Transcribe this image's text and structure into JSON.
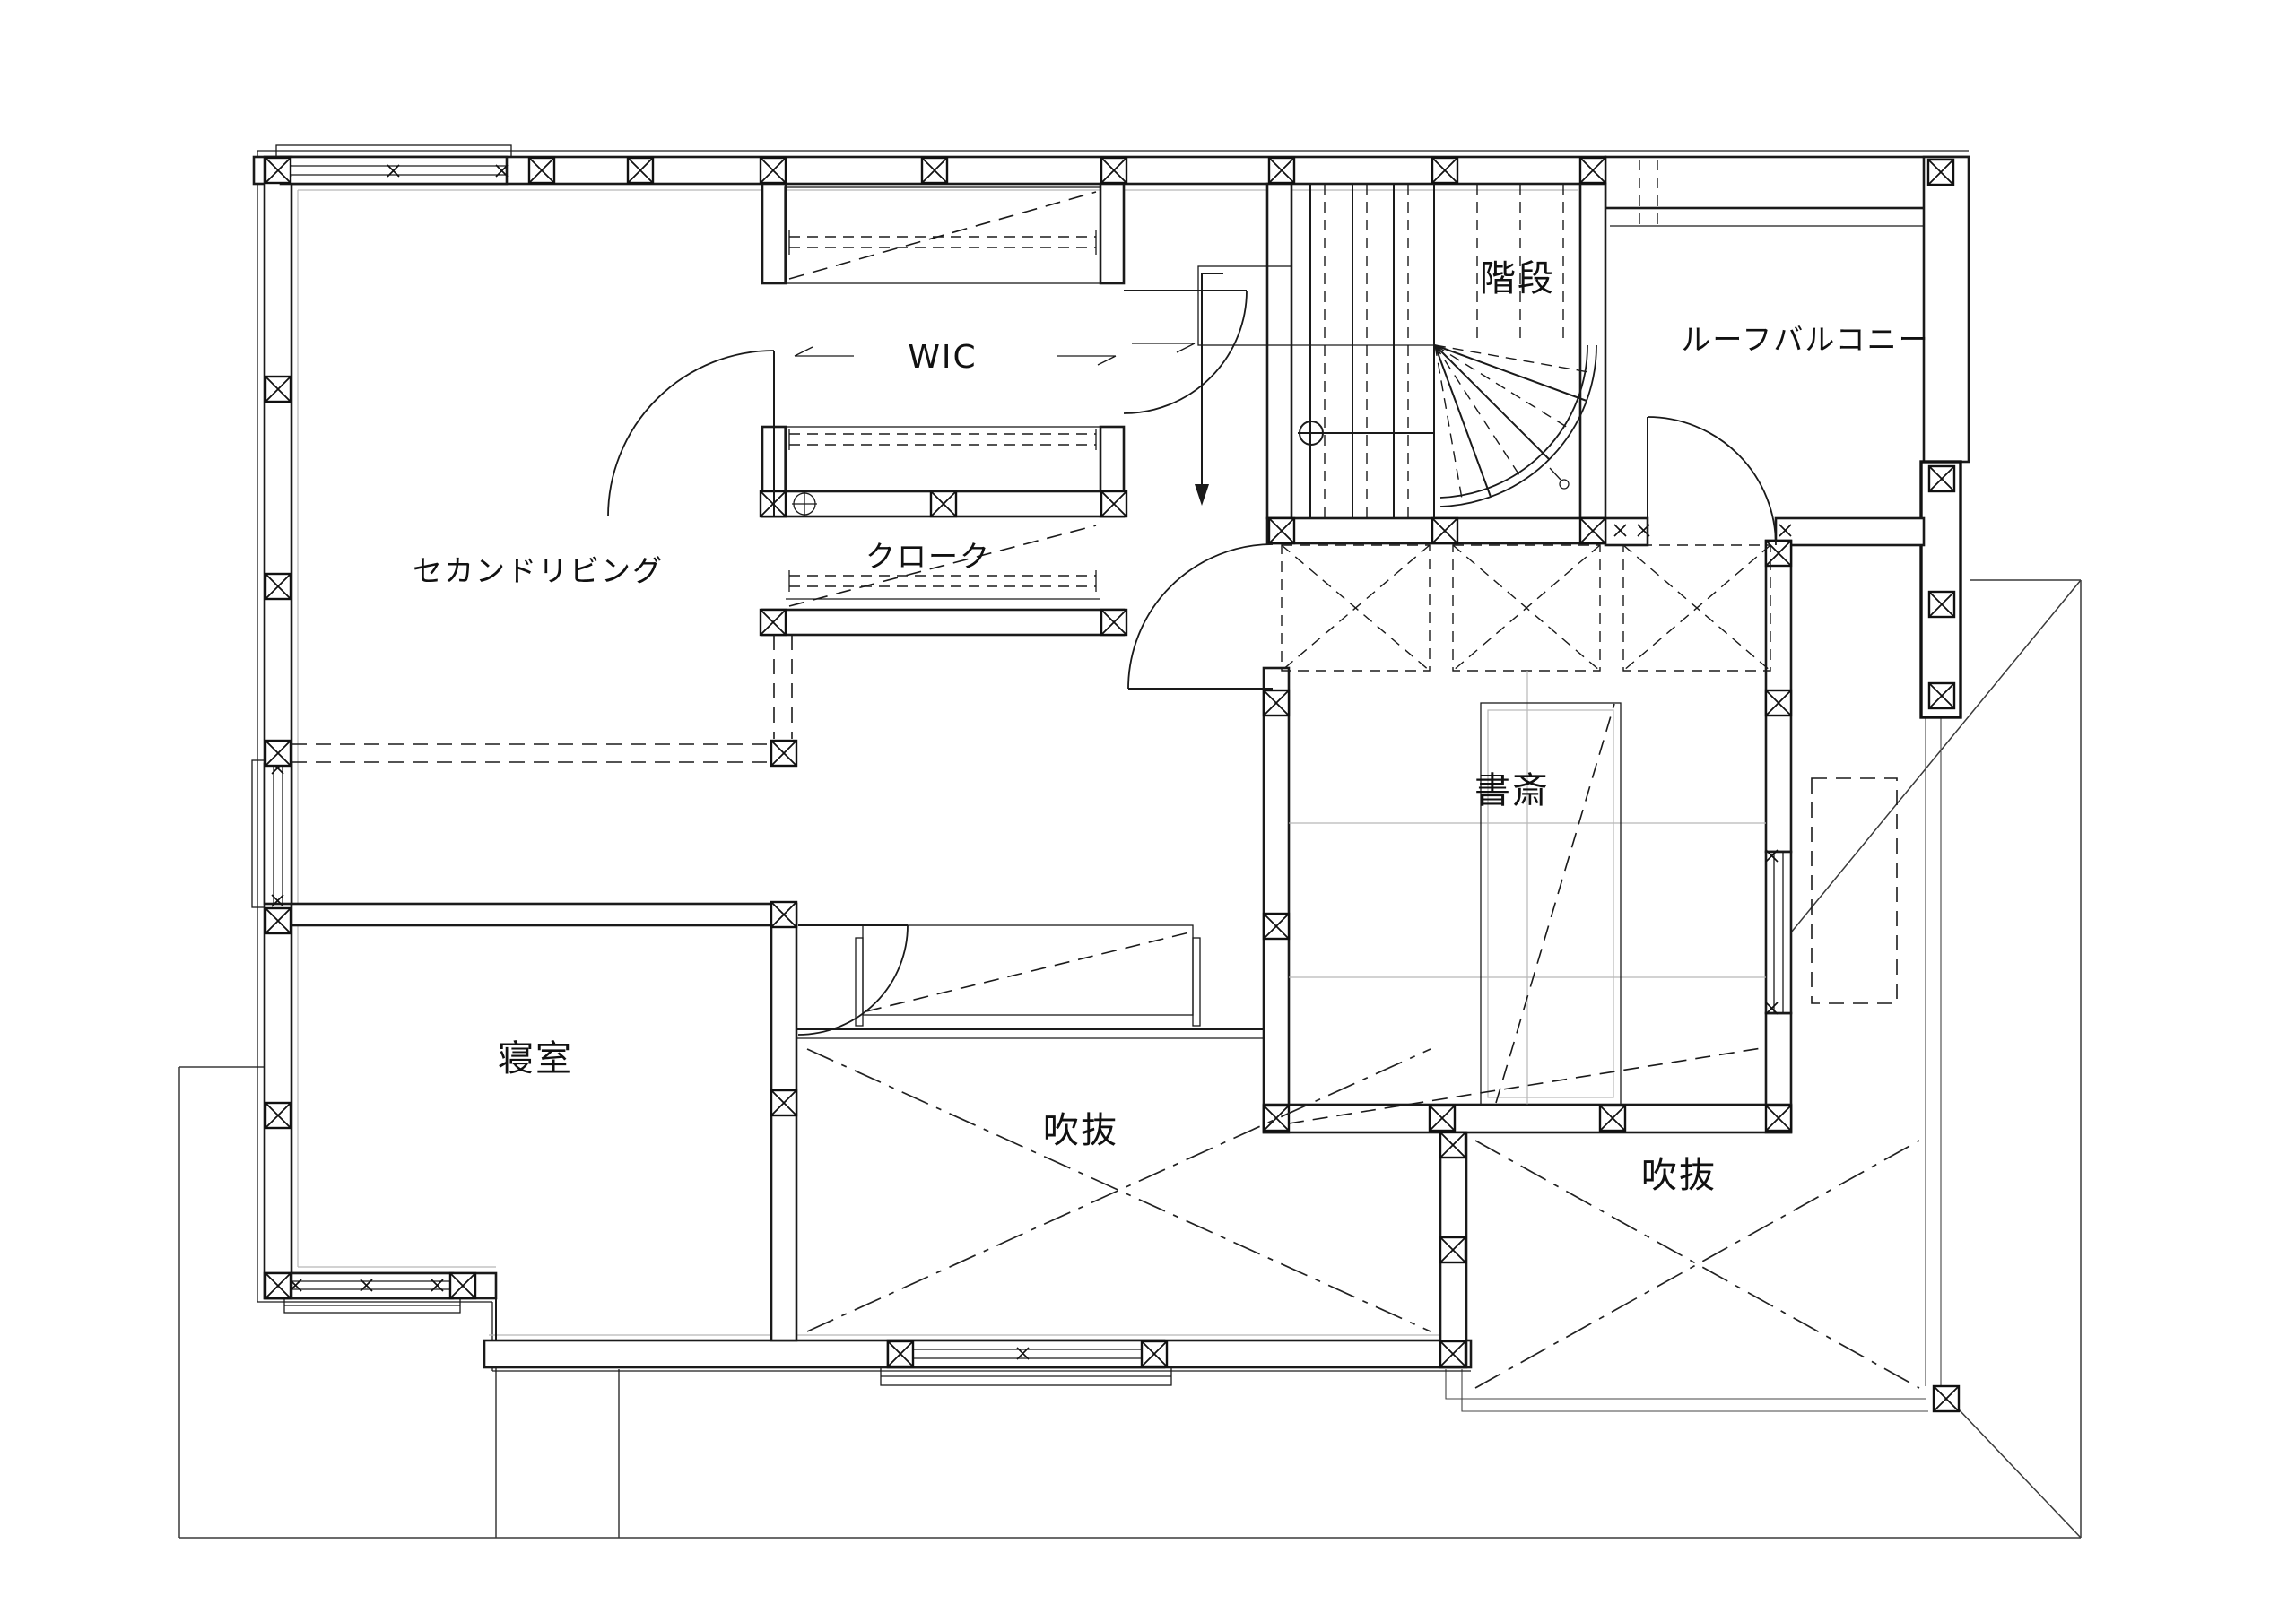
{
  "drawing": {
    "kind": "architectural-floor-plan",
    "rooms": [
      {
        "id": "second-living",
        "label": "セカンドリビング"
      },
      {
        "id": "wic",
        "label": "WIC"
      },
      {
        "id": "cloak",
        "label": "クローク"
      },
      {
        "id": "stairs",
        "label": "階段"
      },
      {
        "id": "roof-balcony",
        "label": "ルーフバルコニー"
      },
      {
        "id": "study",
        "label": "書斎"
      },
      {
        "id": "bedroom",
        "label": "寝室"
      },
      {
        "id": "void-left",
        "label": "吹抜"
      },
      {
        "id": "void-right",
        "label": "吹抜"
      }
    ],
    "colors": {
      "ink": "#1a1a1a",
      "light_grid": "#b8b8b8",
      "background": "#ffffff"
    }
  }
}
